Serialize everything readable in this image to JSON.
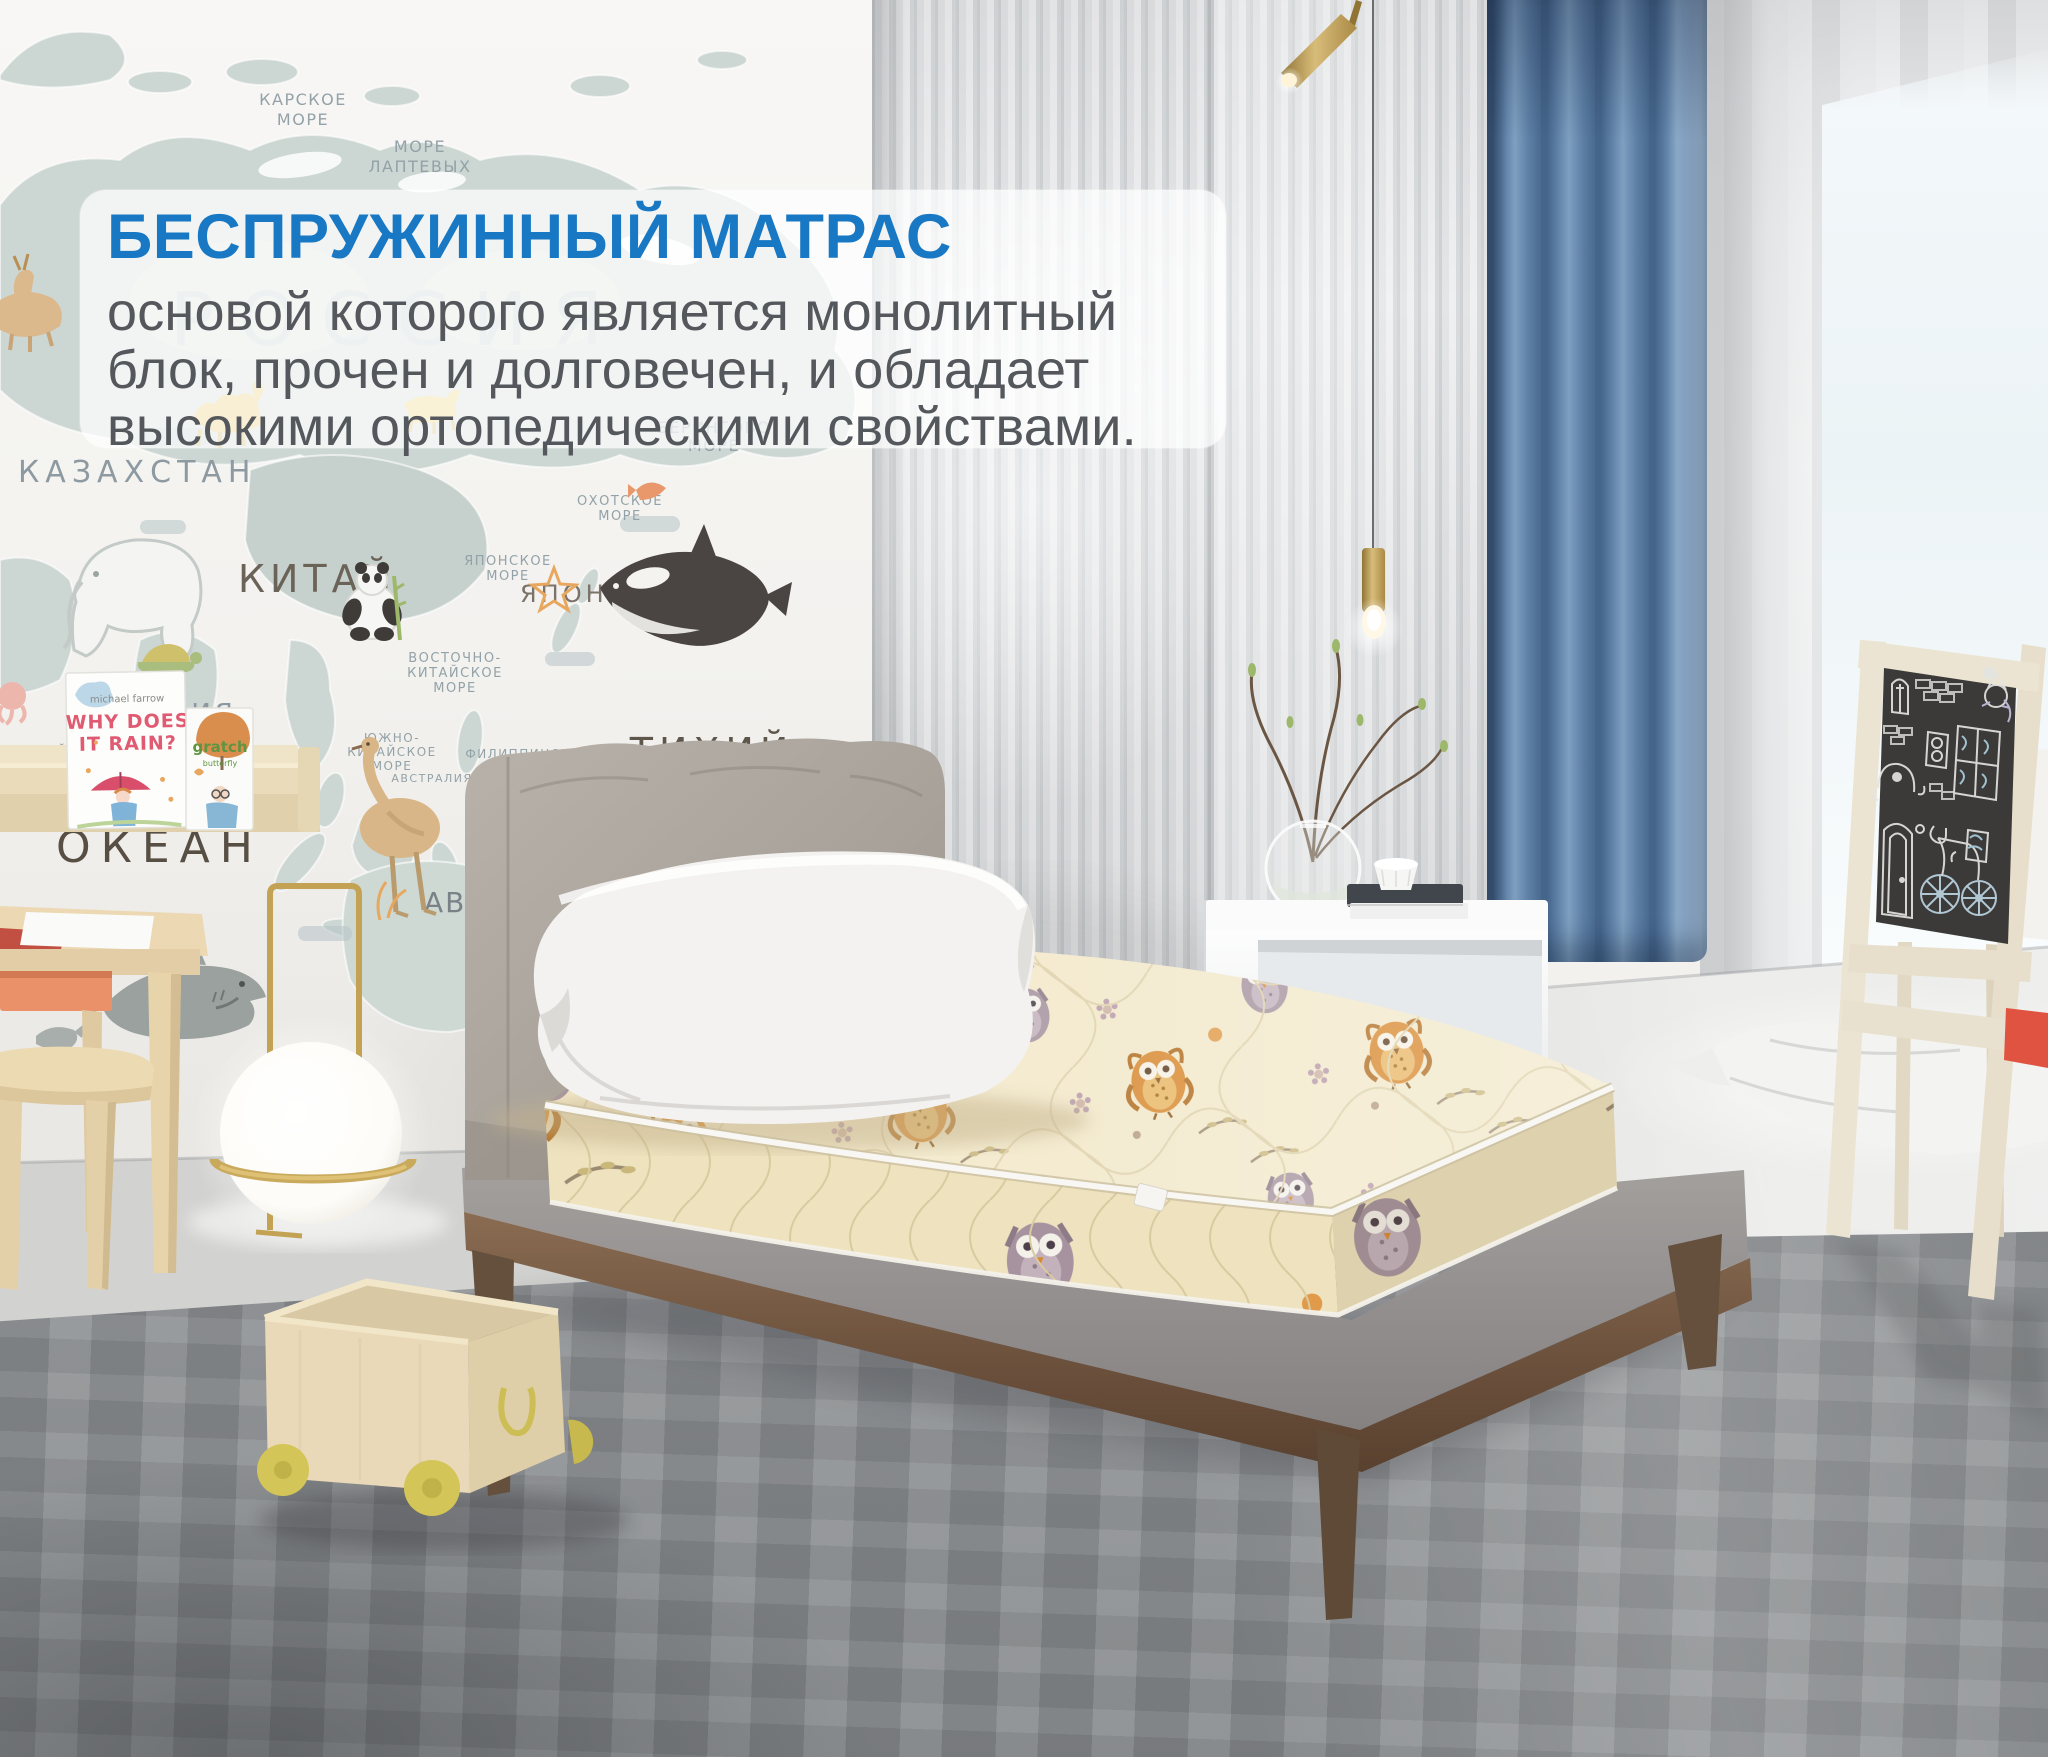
{
  "overlay": {
    "title": "БЕСПРУЖИННЫЙ МАТРАС",
    "line1": "основой которого является монолитный",
    "line2": "блок, прочен и долговечен, и обладает",
    "line3": "высокими ортопедическими свойствами."
  },
  "map": {
    "russia": "РОССИЯ",
    "kara_sea_line1": "КАРСКОЕ",
    "kara_sea_line2": "МОРЕ",
    "laptev_line1": "МОРЕ",
    "laptev_line2": "ЛАПТЕВЫХ",
    "bering_line1": "БЕРИНГОВО",
    "bering_line2": "МОРЕ",
    "okhotsk_line1": "ОХОТСКОЕ",
    "okhotsk_line2": "МОРЕ",
    "japan_sea_line1": "ЯПОНСКОЕ",
    "japan_sea_line2": "МОРЕ",
    "east_china_line1": "ВОСТОЧНО-",
    "east_china_line2": "КИТАЙСКОЕ",
    "east_china_line3": "МОРЕ",
    "south_china_line1": "ЮЖНО-",
    "south_china_line2": "КИТАЙСКОЕ",
    "south_china_line3": "МОРЕ",
    "philippine_line1": "ФИЛИППИНСКОЕ",
    "philippine_line2": "МОРЕ",
    "arabian_line1": "АРАВИЙСКОЕ",
    "arabian_line2": "МОРЕ",
    "kazakhstan": "КАЗАХСТАН",
    "china": "КИТАЙ",
    "japan": "ЯПОНИЯ",
    "india": "ИНДИЯ",
    "australia": "АВСТРАЛИЯ",
    "pacific_line1": "ТИХИЙ",
    "pacific_line2": "ОКЕАН",
    "ocean_big": "ОКЕАН",
    "ocean_fragment": "ипц",
    "abc": "ABC"
  },
  "shelf": {
    "book1_author": "michael farrow",
    "book1_title_line1": "WHY DOES",
    "book1_title_line2": "IT RAIN?",
    "book2_title": "gratch",
    "book2_subtitle": "butterfly"
  },
  "colors": {
    "accent_blue": "#1878c4",
    "body_text": "#54585c",
    "curtain_blue": "#5d7fa5",
    "mattress_cream": "#f2e8c9",
    "owl_orange": "#d8892f",
    "wood": "#7b6048"
  }
}
